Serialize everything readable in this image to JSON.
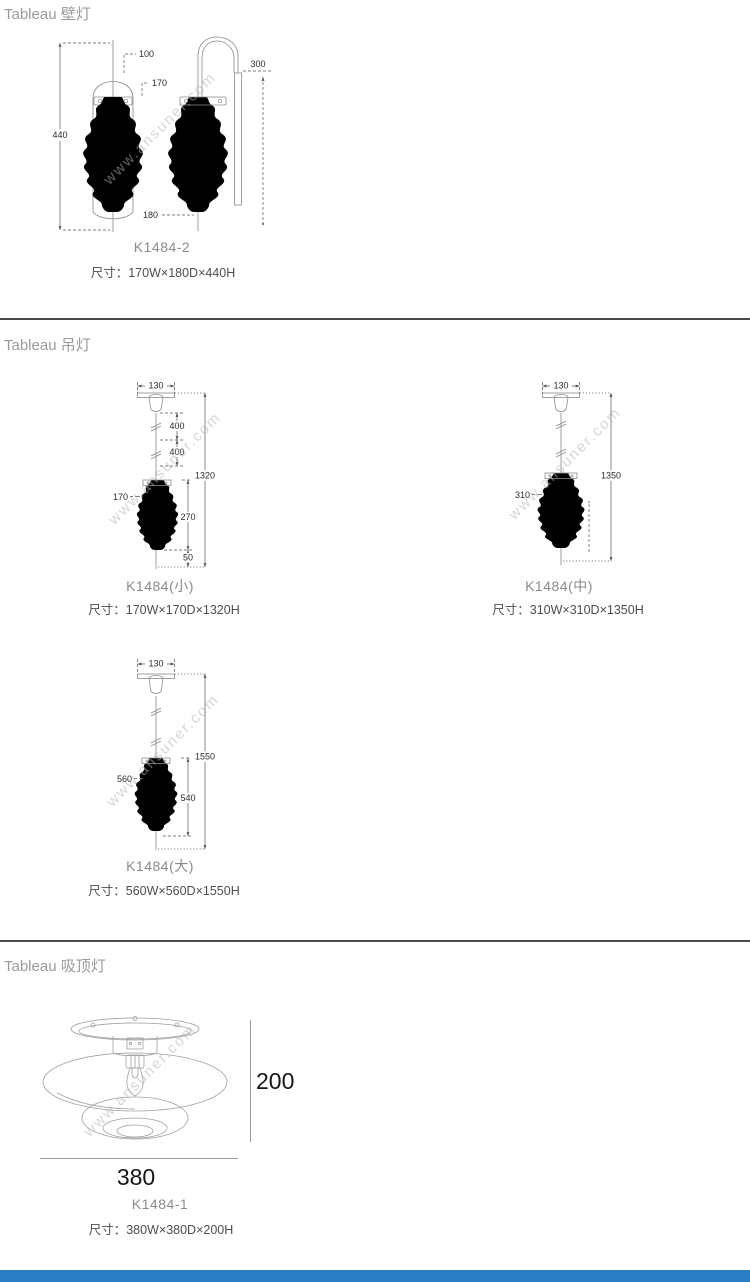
{
  "watermark": "www.ansuner.com",
  "wall": {
    "header": "Tableau 壁灯",
    "model": "K1484-2",
    "size": "尺寸：170W×180D×440H",
    "dim_height": "440",
    "dim_top": "100",
    "dim_glass": "170",
    "dim_bottom": "180",
    "dim_backplate": "300"
  },
  "pendant": {
    "header": "Tableau 吊灯",
    "small": {
      "model": "K1484(小)",
      "size": "尺寸：170W×170D×1320H",
      "dim_canopy": "130",
      "dim_wire1": "400",
      "dim_wire2": "400",
      "dim_total": "1320",
      "dim_width": "170",
      "dim_shade": "270",
      "dim_tip": "50"
    },
    "medium": {
      "model": "K1484(中)",
      "size": "尺寸：310W×310D×1350H",
      "dim_canopy": "130",
      "dim_total": "1350",
      "dim_width": "310"
    },
    "large": {
      "model": "K1484(大)",
      "size": "尺寸：560W×560D×1550H",
      "dim_canopy": "130",
      "dim_total": "1550",
      "dim_width": "560",
      "dim_shade": "540"
    }
  },
  "ceiling": {
    "header": "Tableau 吸顶灯",
    "model": "K1484-1",
    "size": "尺寸：380W×380D×200H",
    "dim_height": "200",
    "dim_width": "380"
  },
  "colors": {
    "divider": "#4a4a4a",
    "footer_bar": "#2b80c5",
    "accent_text": "#9a9a9a"
  }
}
